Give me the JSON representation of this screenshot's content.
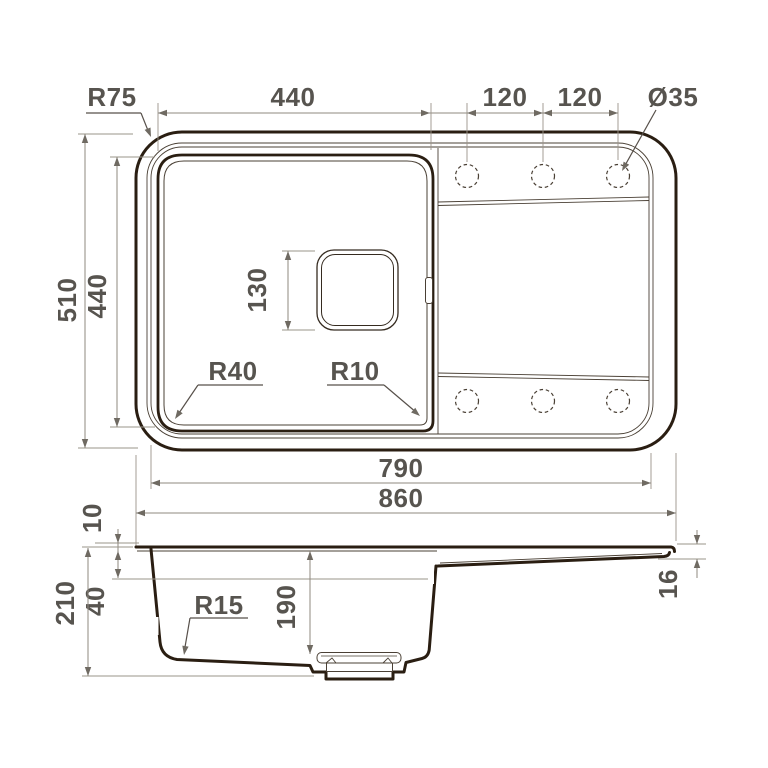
{
  "drawing_title": "kitchen-sink-technical-drawing",
  "colors": {
    "background": "#ffffff",
    "outline_bold": "#2a1e12",
    "outline_thin": "#4a4035",
    "dimension_line": "#8f897f",
    "dimension_text": "#57544f"
  },
  "top_view": {
    "corner_radius_label": "R75",
    "bowl_width": "440",
    "hole_pitch_left": "120",
    "hole_pitch_right": "120",
    "hole_diameter": "Ø35",
    "overall_depth": "510",
    "bowl_depth": "440",
    "drain_size": "130",
    "bowl_corner_radius": "R40",
    "bowl_inner_radius": "R10",
    "inner_length": "790",
    "overall_length": "860"
  },
  "section_view": {
    "rim_height": "10",
    "total_height": "210",
    "ledge_height": "40",
    "floor_radius": "R15",
    "bowl_inner_depth": "190",
    "edge_height": "16"
  }
}
